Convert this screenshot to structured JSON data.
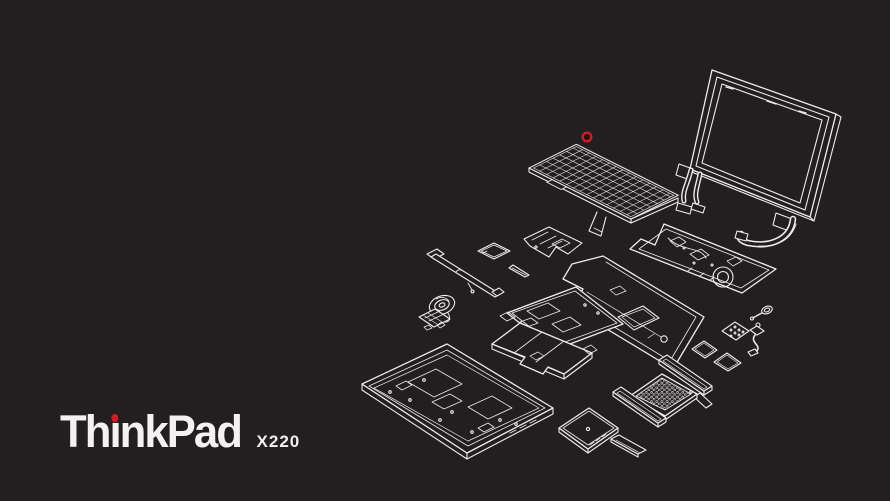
{
  "colors": {
    "background": "#231f20",
    "line": "#ececec",
    "accent_red": "#cc2027",
    "text": "#f3f1f1"
  },
  "logo": {
    "brand_prefix": "Th",
    "brand_i": "ı",
    "brand_suffix": "nkPad",
    "model": "X220"
  },
  "parts": [
    {
      "id": "display-assembly"
    },
    {
      "id": "lcd-cables"
    },
    {
      "id": "keyboard"
    },
    {
      "id": "trackpoint-cap"
    },
    {
      "id": "card-reader-board"
    },
    {
      "id": "wireless-card"
    },
    {
      "id": "mounting-bracket"
    },
    {
      "id": "hinge-rail"
    },
    {
      "id": "speaker-assembly"
    },
    {
      "id": "motherboard"
    },
    {
      "id": "palm-rest"
    },
    {
      "id": "structure-frame"
    },
    {
      "id": "battery"
    },
    {
      "id": "base-chassis"
    },
    {
      "id": "hard-drive"
    },
    {
      "id": "drive-bay-cover"
    },
    {
      "id": "heatsink-grille"
    },
    {
      "id": "memory-module-1"
    },
    {
      "id": "memory-module-2"
    },
    {
      "id": "expansion-card-1"
    },
    {
      "id": "expansion-card-2"
    },
    {
      "id": "perforated-card"
    },
    {
      "id": "latch-lever"
    },
    {
      "id": "dc-jack-cable"
    }
  ]
}
